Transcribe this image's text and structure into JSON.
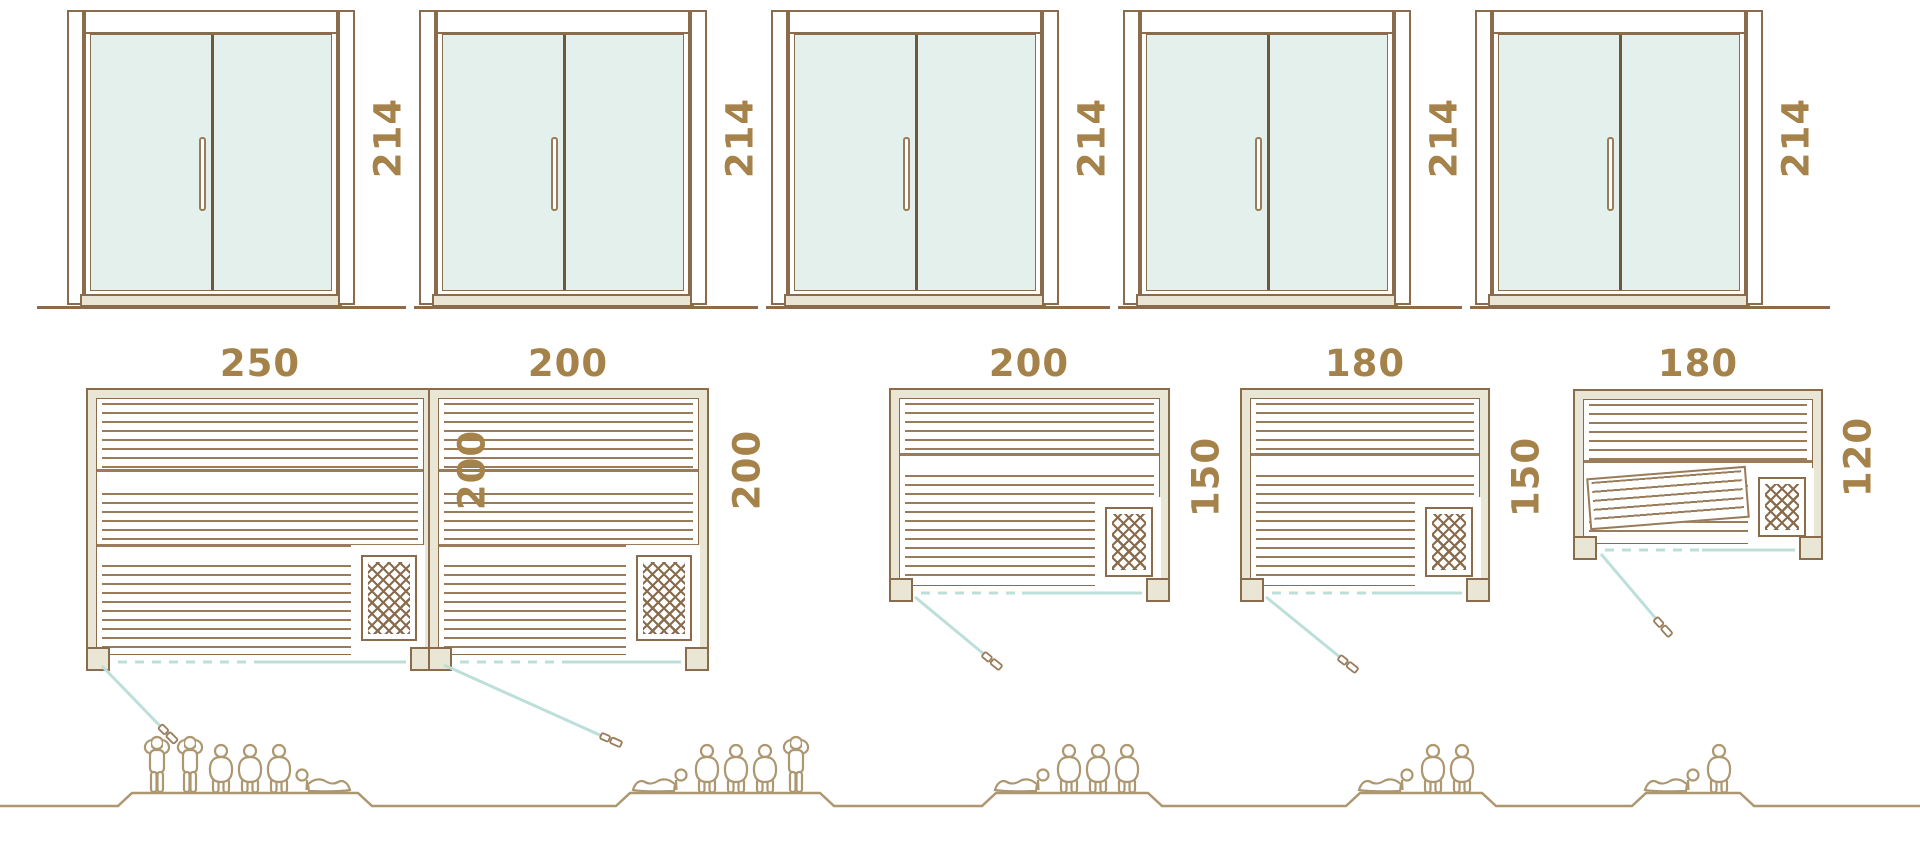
{
  "columns": [
    {
      "door_height": "214",
      "plan_width": "250",
      "plan_depth": "200",
      "people_count": 6,
      "people": [
        "standing",
        "standing",
        "seated",
        "seated",
        "seated",
        "reclining-left"
      ]
    },
    {
      "door_height": "214",
      "plan_width": "200",
      "plan_depth": "200",
      "people_count": 5,
      "people": [
        "reclining-right",
        "seated",
        "seated",
        "seated",
        "standing"
      ]
    },
    {
      "door_height": "214",
      "plan_width": "200",
      "plan_depth": "150",
      "people_count": 4,
      "people": [
        "reclining-right",
        "seated",
        "seated",
        "seated"
      ]
    },
    {
      "door_height": "214",
      "plan_width": "180",
      "plan_depth": "150",
      "people_count": 3,
      "people": [
        "reclining-right",
        "seated",
        "seated"
      ]
    },
    {
      "door_height": "214",
      "plan_width": "180",
      "plan_depth": "120",
      "people_count": 2,
      "people": [
        "reclining-right",
        "seated"
      ]
    }
  ],
  "icons": {
    "heater": "heater-lattice-icon",
    "door_swing": "door-swing-arc-icon",
    "plan_handle": "door-handle-icon",
    "people": [
      "person-standing-icon",
      "person-seated-icon",
      "person-reclining-icon"
    ]
  },
  "colors": {
    "outline_brown": "#8a6c4c",
    "dark_brown": "#6e573c",
    "slat_brown": "#9a7c5a",
    "wall_beige": "#e9e6d5",
    "label_gold": "#a5824a",
    "glass_mint": "#e4f0ec",
    "teal_line": "#bcdfd9",
    "people_tan": "#ac9770"
  }
}
